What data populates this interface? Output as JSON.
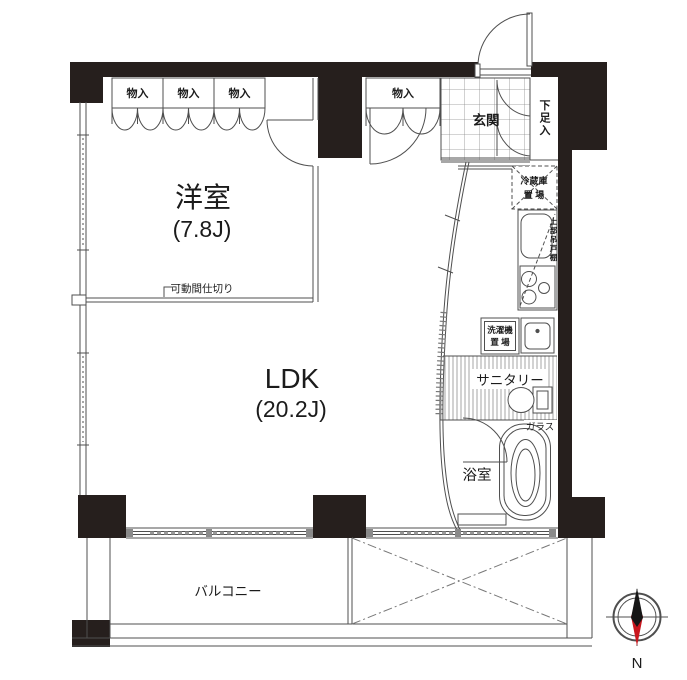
{
  "floorplan": {
    "rooms": {
      "western_room": {
        "name": "洋室",
        "size": "(7.8J)"
      },
      "ldk": {
        "name": "LDK",
        "size": "(20.2J)"
      },
      "entrance": {
        "name": "玄関"
      },
      "bathroom": {
        "name": "浴室"
      },
      "sanitary": {
        "name": "サニタリー"
      },
      "balcony": {
        "name": "バルコニー"
      }
    },
    "fixtures": {
      "closet": "物入",
      "shoe_cabinet": "下足入",
      "refrigerator": {
        "line1": "冷蔵庫",
        "line2": "置 場"
      },
      "upper_cabinet": "上部吊戸棚",
      "washer": {
        "line1": "洗濯機",
        "line2": "置 場"
      },
      "glass": "ガラス",
      "movable_partition": "可動間仕切り"
    },
    "compass": {
      "north_label": "N"
    },
    "colors": {
      "wall": "#261f1d",
      "line": "#4f4f4f",
      "compass_red": "#c8161d",
      "compass_black": "#161616"
    }
  }
}
